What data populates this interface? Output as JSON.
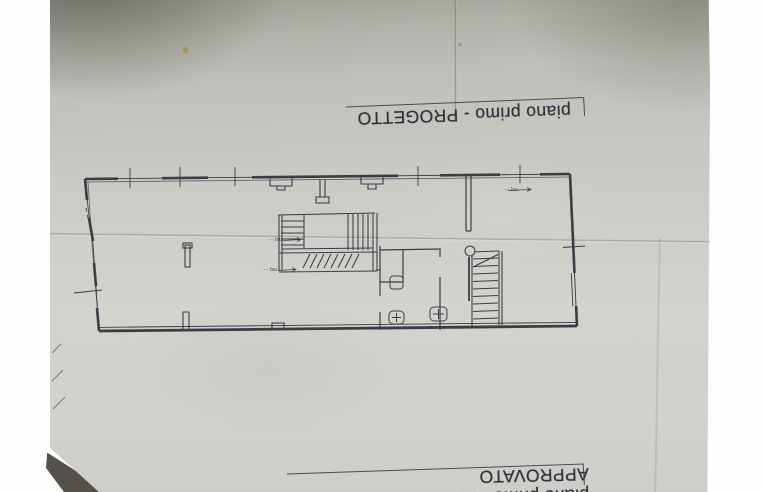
{
  "titles": {
    "top": "piano primo - PROGETTO",
    "bottom": "piano primo - PROGETTO APPROVATO"
  },
  "plan_annotations": {
    "a1": "mq ····",
    "a2": "mq ····",
    "a3": "mq ····"
  },
  "colors": {
    "paper": "#cfcec9",
    "ink": "#3c3c44",
    "background_white": "#fefefe",
    "corner_shadow": "#53514a",
    "stain": "#ab8d3a"
  }
}
